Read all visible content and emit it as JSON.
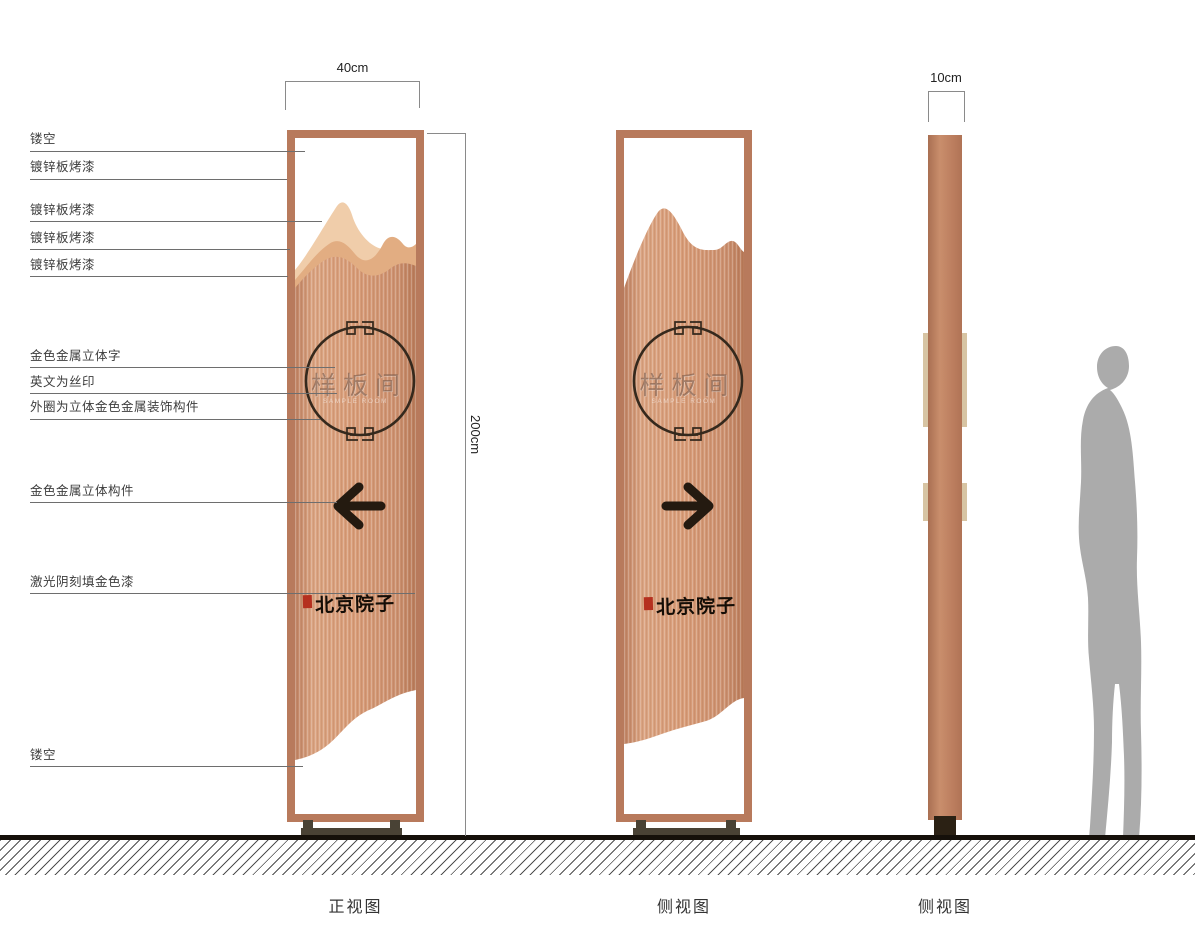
{
  "page": {
    "background": "#ffffff",
    "description": "signage pylon design drawing with three views"
  },
  "dims": {
    "front_width": "40cm",
    "height": "200cm",
    "side_width": "10cm"
  },
  "annotations": {
    "left_labels": [
      {
        "text": "镂空"
      },
      {
        "text": "镀锌板烤漆"
      },
      {
        "text": "镀锌板烤漆"
      },
      {
        "text": "镀锌板烤漆"
      },
      {
        "text": "镀锌板烤漆"
      },
      {
        "text": "金色金属立体字"
      },
      {
        "text": "英文为丝印"
      },
      {
        "text": "外圈为立体金色金属装饰构件"
      },
      {
        "text": "金色金属立体构件"
      },
      {
        "text": "激光阴刻填金色漆"
      },
      {
        "text": "镂空"
      }
    ]
  },
  "sign": {
    "room_label": "样板间",
    "english_subtitle": "SAMPLE ROOM",
    "brand": "北京院子",
    "front_arrow_direction": "left",
    "side_arrow_direction": "right"
  },
  "views": [
    {
      "caption": "正视图"
    },
    {
      "caption": "侧视图"
    },
    {
      "caption": "侧视图"
    }
  ],
  "colors": {
    "frame_copper": "#b87a5c",
    "panel_copper": "#d89d79",
    "mountain_light": "#f0cdaa",
    "mountain_mid": "#e2ad82",
    "accent_dark": "#241a10",
    "seal_red": "#b5301f",
    "base_dark": "#494235",
    "side_strip_beige": "#d7c4a3",
    "person_gray": "#ababab"
  }
}
